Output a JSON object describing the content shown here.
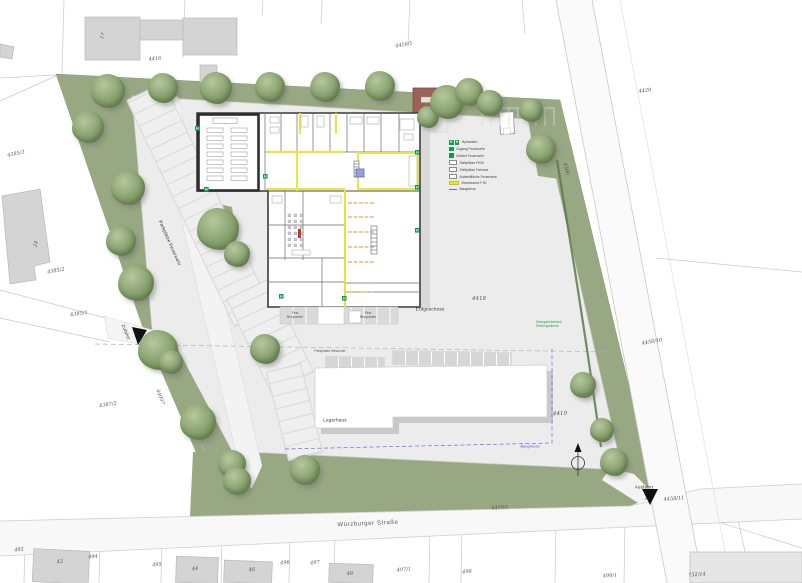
{
  "map": {
    "street_name": "Würzburger Straße",
    "labels": {
      "zufahrt": "Zufahrt",
      "ausfahrt": "Ausfahrt",
      "parkplaetze_feuerwehr": "Parkplätze Feuerwehr",
      "parkplaetze_besucher": "Parkplätze Besucher",
      "lagerhaus": "Lagerhaus",
      "erdgeschoss": "Erdgeschoss",
      "first_responder_1": "First Responder",
      "first_responder_2": "First Responder",
      "uebergabebereich": "Übergabebereich Rettungsdienst",
      "baugrenze": "Baugrenze"
    },
    "parcels": {
      "17": "17",
      "24": "24",
      "42": "42",
      "44": "44",
      "46": "46",
      "48": "48",
      "493": "493",
      "494": "494",
      "495": "495",
      "496": "496",
      "497": "497",
      "497_1": "497/1",
      "498": "498",
      "499_1": "499/1",
      "732_14": "732/14",
      "4416": "4416",
      "4416_1": "4416/1",
      "4418": "4418",
      "4419": "4419",
      "4419_1": "4419/1",
      "4420": "4420",
      "4300": "4300",
      "44007": "44007",
      "4385_1": "4385/1",
      "4385_2": "4385/2",
      "4385_3": "4385/3",
      "4387_2": "4387/2",
      "4458_10": "4458/10",
      "4458_11": "4458/11"
    },
    "legend": {
      "items": [
        {
          "icon": "hydrant-double",
          "label": "Hydranten"
        },
        {
          "icon": "access-green",
          "label": "Zugang Feuerwehr"
        },
        {
          "icon": "exit-green",
          "label": "Zufahrt Feuerwehr"
        },
        {
          "icon": "stall-gray",
          "label": "Stellplätze PKW"
        },
        {
          "icon": "bike-gray",
          "label": "Stellplätze Fahrrad"
        },
        {
          "icon": "area-gray",
          "label": "Aufstellfläche Feuerwehr"
        },
        {
          "icon": "line-yellow",
          "label": "Brandwand F 90"
        },
        {
          "icon": "line-blue",
          "label": "Baugrenze"
        }
      ]
    },
    "colors": {
      "green_area": "#98a883",
      "tree": "#78935f",
      "paving": "#ececec",
      "neighbor_building": "#d4d4d4",
      "red_building": "#9a6358",
      "wall": "#3a3a3a",
      "brandwand_yellow": "#e8e832",
      "baugrenze_blue": "#6a6ad6",
      "hydrant_green": "#18984e"
    }
  }
}
